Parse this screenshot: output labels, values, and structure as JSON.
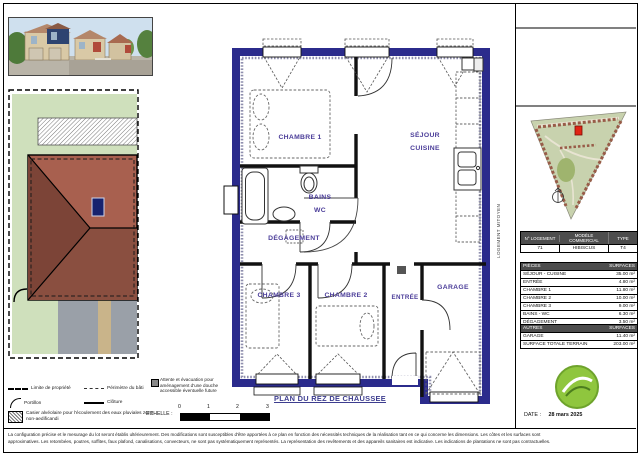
{
  "colors": {
    "wall_navy": "#2b2b8c",
    "room_label": "#4b3d99",
    "lot_green": "#cfe0bc",
    "roof_light": "#a8604f",
    "roof_dark": "#7c4437",
    "logo_green": "#8fc63e",
    "table_header_bg": "#4d4d4d"
  },
  "floor_plan": {
    "labels": {
      "ch1": "CHAMBRE 1",
      "sejour1": "SÉJOUR",
      "sejour2": "CUISINE",
      "bains1": "BAINS",
      "bains2": "WC",
      "degagement": "DÉGAGEMENT",
      "ch3": "CHAMBRE 3",
      "ch2": "CHAMBRE 2",
      "entree": "ENTRÉE",
      "garage": "GARAGE"
    },
    "party_wall": "LOGEMENT MITOYEN",
    "title": "PLAN DU REZ DE CHAUSSEE",
    "note": "Attente et évacuation pour aménagement d'une douche accessible éventuelle future",
    "scale": {
      "label": "ECHELLE :",
      "ticks": [
        "0",
        "1",
        "2",
        "3"
      ]
    }
  },
  "legend": {
    "limite": "Limite de propriété",
    "perimetre": "Périmètre du bâti",
    "portillon": "Portillon",
    "cloture": "Clôture",
    "casier": "Casier alvéolaire pour l'écoulement des eaux pluviales zone non-aedificandi"
  },
  "right_panel": {
    "lot_table": {
      "col1": "N° LOGEMENT",
      "col2": "MODÈLE COMMERCIAL",
      "col3": "TYPE",
      "v1": "71",
      "v2": "HIBISCUS",
      "v3": "T4"
    },
    "rooms_table": {
      "h1": "PIÈCES",
      "h2": "SURFACES",
      "rows": [
        [
          "SÉJOUR - CUISINE",
          "35.00 m²"
        ],
        [
          "ENTRÉE",
          "4.80 m²"
        ],
        [
          "CHAMBRE 1",
          "11.80 m²"
        ],
        [
          "CHAMBRE 2",
          "10.00 m²"
        ],
        [
          "CHAMBRE 3",
          "9.00 m²"
        ],
        [
          "BAINS - WC",
          "6.30 m²"
        ],
        [
          "DÉGAGEMENT",
          "3.50 m²"
        ]
      ],
      "total_label": "TOTAL",
      "total_value": "80.00 m²"
    },
    "others_table": {
      "h1": "AUTRES",
      "h2": "SURFACES",
      "rows": [
        [
          "GARAGE",
          "11.40 m²"
        ],
        [
          "SURFACE TOTALE TERRAIN",
          "203.00 m²"
        ]
      ]
    },
    "date_label": "DATE :",
    "date_value": "28 mars 2025"
  },
  "footer": {
    "line1": "La configuration précise et le mesurage du lot seront établis ultérieurement. Des modifications sont susceptibles d'être apportées à ce plan en fonction des nécessités techniques de la réalisation tant en ce qui concerne les dimensions. Les côtes et les surfaces sont",
    "line2": "approximatives. Les retombées, poutres, soffites, faux plafond, canalisations, convecteurs, ne sont pas systématiquement représentés. La représentation des revêtements et des appareils sanitaires est indicative. Les indications de plantations ne sont pas contractuelles."
  }
}
